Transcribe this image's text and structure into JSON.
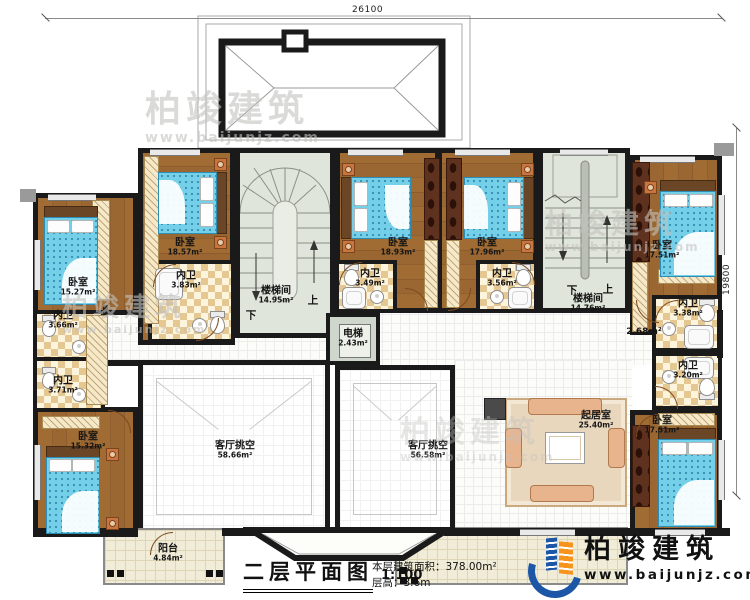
{
  "dimensions": {
    "top": "26100",
    "right": "19800"
  },
  "stairs": {
    "up": "上",
    "down": "下"
  },
  "rooms": [
    {
      "label": "卧室",
      "area": "15.27m²"
    },
    {
      "label": "内卫",
      "area": "3.66m²"
    },
    {
      "label": "内卫",
      "area": "3.71m²"
    },
    {
      "label": "卧室",
      "area": "15.32m²"
    },
    {
      "label": "卧室",
      "area": "18.57m²"
    },
    {
      "label": "内卫",
      "area": "3.83m²"
    },
    {
      "label": "楼梯间",
      "area": "14.95m²"
    },
    {
      "label": "卧室",
      "area": "18.93m²"
    },
    {
      "label": "内卫",
      "area": "3.49m²"
    },
    {
      "label": "电梯",
      "area": "2.43m²"
    },
    {
      "label": "卧室",
      "area": "17.96m²"
    },
    {
      "label": "内卫",
      "area": "3.56m²"
    },
    {
      "label": "楼梯间",
      "area": "14.76m²"
    },
    {
      "label": "卧室",
      "area": "17.51m²"
    },
    {
      "label": "内卫",
      "area": "3.38m²"
    },
    {
      "label": "",
      "area": "2.68m²"
    },
    {
      "label": "内卫",
      "area": "3.20m²"
    },
    {
      "label": "卧室",
      "area": "17.51m²"
    },
    {
      "label": "起居室",
      "area": "25.40m²"
    },
    {
      "label": "客厅挑空",
      "area": "58.66m²"
    },
    {
      "label": "客厅挑空",
      "area": "56.58m²"
    },
    {
      "label": "阳台",
      "area": "4.84m²"
    }
  ],
  "title_block": {
    "title": "二层平面图",
    "scale": "1:100",
    "area_line": "本层建筑面积：378.00m²",
    "height_line": "层高：3.6m"
  },
  "brand": {
    "name": "柏竣建筑",
    "url": "www.baijunjz.com"
  },
  "watermark": {
    "name": "柏竣建筑",
    "url": "www.baijunjz.com"
  }
}
